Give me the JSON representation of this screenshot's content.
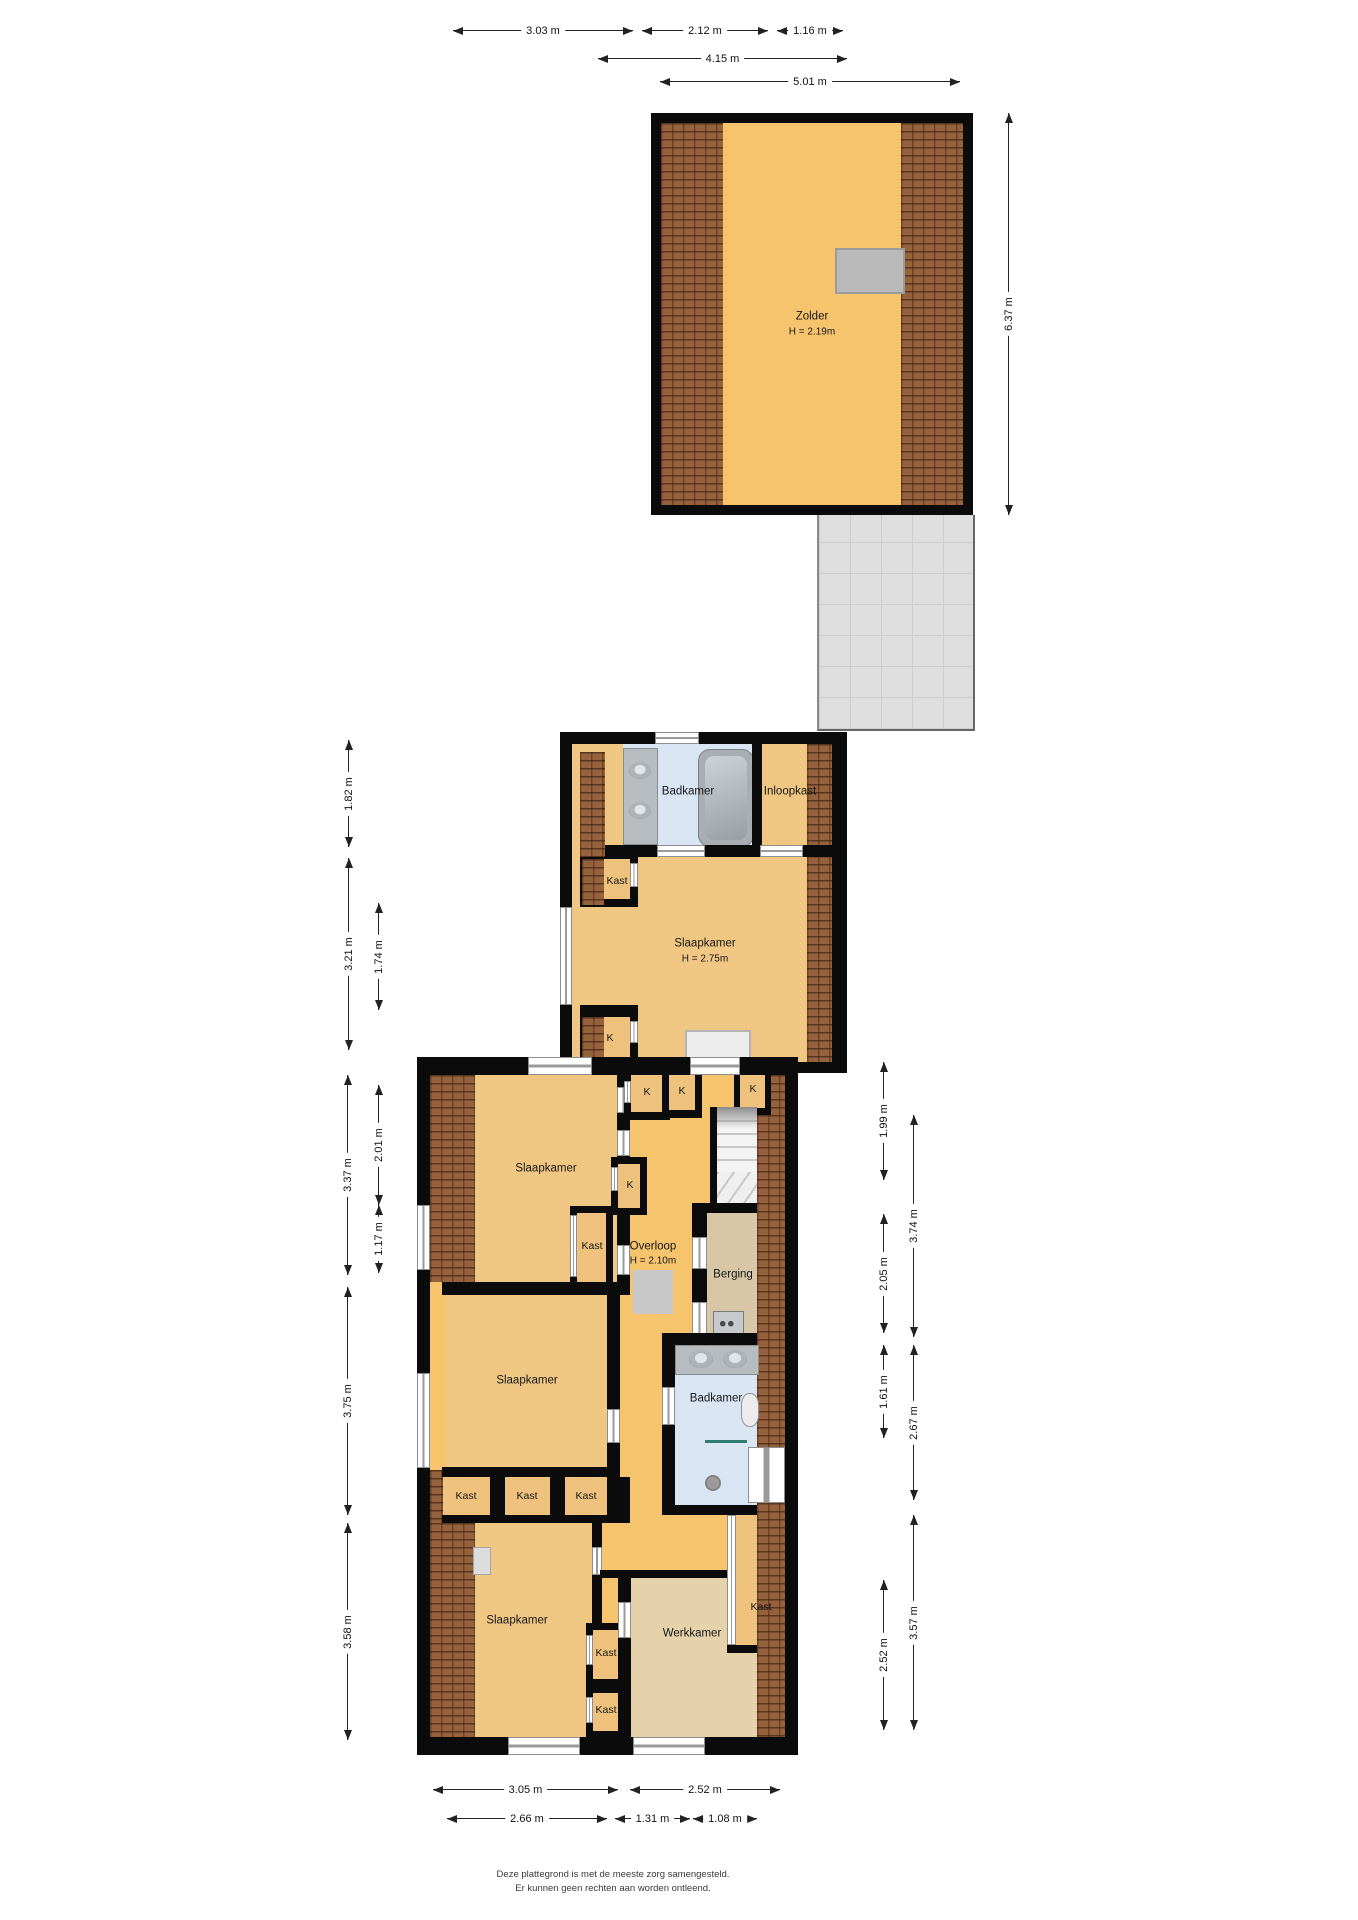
{
  "rooms": {
    "zolder": {
      "label": "Zolder",
      "height": "H = 2.19m"
    },
    "f2": {
      "badkamer": "Badkamer",
      "inloopkast": "Inloopkast",
      "kast": "Kast",
      "slaapkamer": "Slaapkamer",
      "slaapkamer_h": "H = 2.75m",
      "k": "K"
    },
    "f1": {
      "slaapkamer_tl": "Slaapkamer",
      "k_a": "K",
      "k_b": "K",
      "k_c": "K",
      "k_mid": "K",
      "kast_hall": "Kast",
      "overloop": "Overloop",
      "overloop_h": "H = 2.10m",
      "berging": "Berging",
      "badkamer": "Badkamer",
      "kast_1": "Kast",
      "kast_2": "Kast",
      "kast_3": "Kast",
      "slaapkamer_ml": "Slaapkamer",
      "slaapkamer_bl": "Slaapkamer",
      "kast_m1": "Kast",
      "kast_m2": "Kast",
      "werkkamer": "Werkkamer",
      "kast_r": "Kast"
    }
  },
  "dims": {
    "top": [
      "3.03 m",
      "2.12 m",
      "1.16 m",
      "4.15 m",
      "5.01 m"
    ],
    "zolder_right": "6.37 m",
    "f2_left": [
      "1.82 m",
      "3.21 m",
      "1.74 m"
    ],
    "f1_left": [
      "3.37 m",
      "2.01 m",
      "1.17 m",
      "3.75 m",
      "3.58 m"
    ],
    "f1_right": [
      "1.99 m",
      "3.74 m",
      "2.05 m",
      "1.61 m",
      "2.67 m",
      "2.52 m",
      "3.57 m"
    ],
    "bottom": [
      "3.05 m",
      "2.52 m",
      "2.66 m",
      "1.31 m",
      "1.08 m"
    ]
  },
  "footer": {
    "line1": "Deze plattegrond is met de meeste zorg samengesteld.",
    "line2": "Er kunnen geen rechten aan worden ontleend."
  }
}
